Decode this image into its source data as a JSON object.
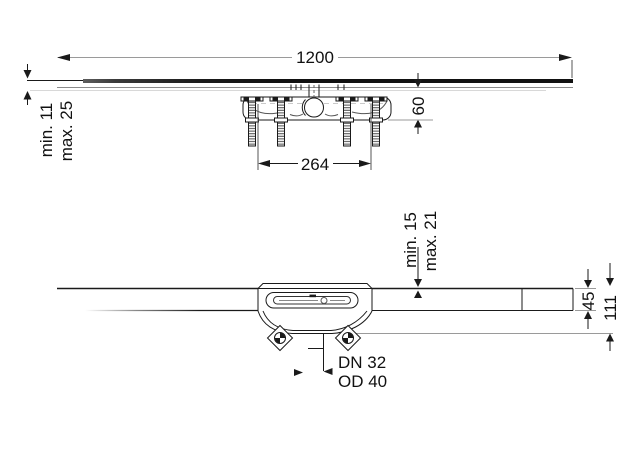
{
  "drawing": {
    "type": "technical-installation-drawing",
    "top_view": {
      "dim_length": "1200",
      "dim_depth": "60",
      "dim_trap_span": "264",
      "covering_min": "min. 11",
      "covering_max": "max. 25"
    },
    "side_view": {
      "covering_min": "min. 15",
      "covering_max": "max. 21",
      "dim_channel_height": "45",
      "dim_total_height": "111",
      "outlet_dn": "DN 32",
      "outlet_od": "OD 40"
    },
    "colors": {
      "line": "#1a1a1a",
      "dimension_line": "#9a9a9a",
      "background": "#ffffff"
    }
  }
}
